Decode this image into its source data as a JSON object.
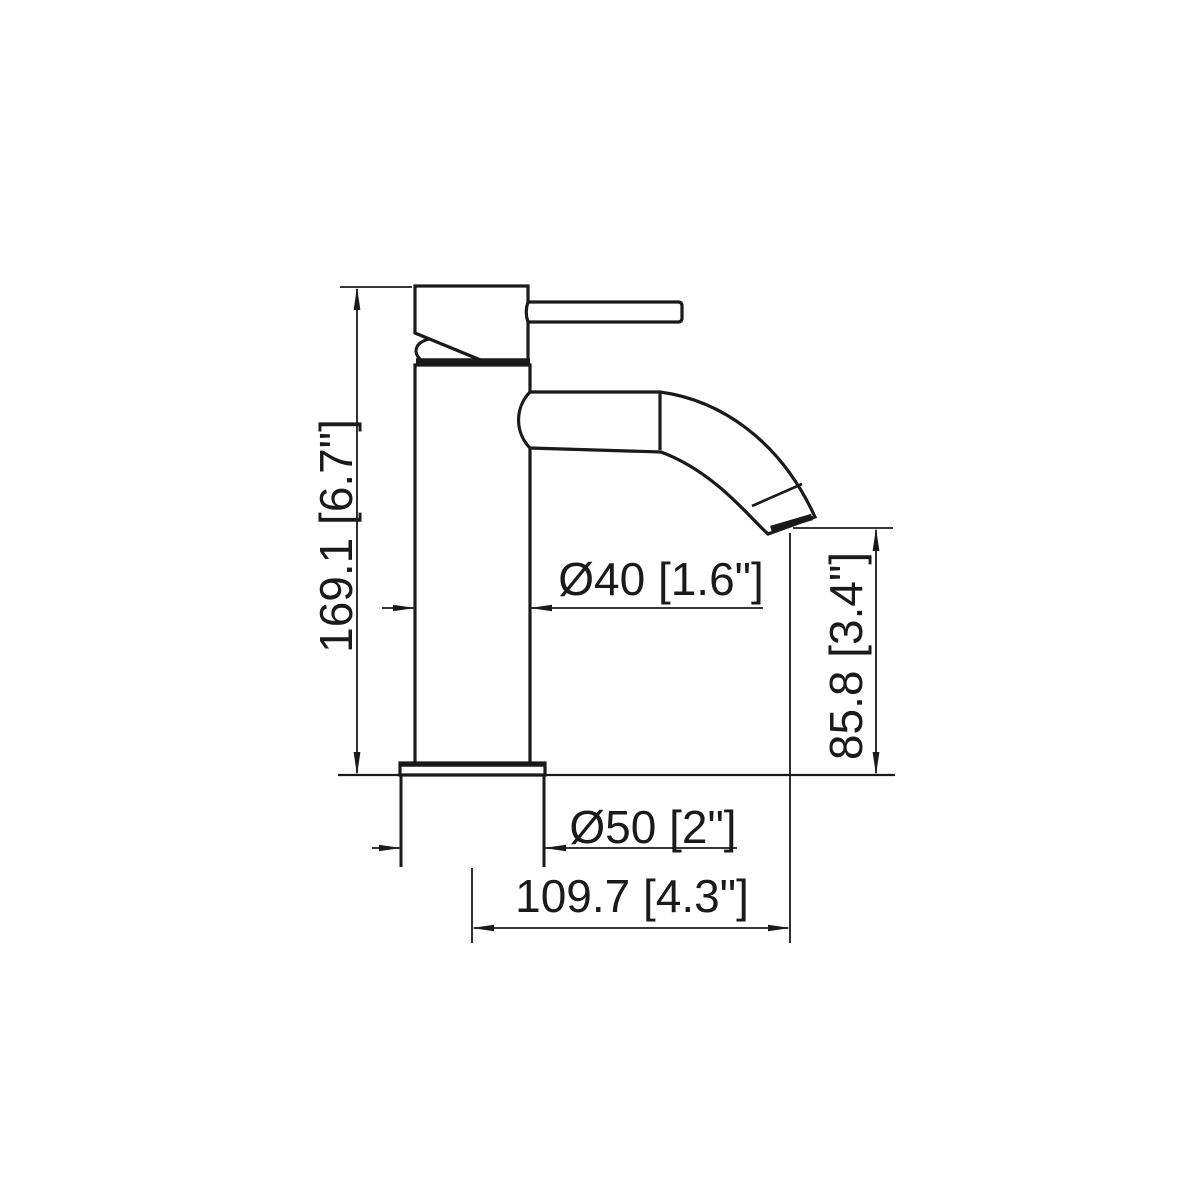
{
  "drawing": {
    "kind": "technical-dimension-drawing",
    "subject": "single-handle basin faucet, side elevation",
    "background_color": "#ffffff",
    "line_color": "#1a1a1a",
    "dimensions": {
      "total_height": {
        "label": "169.1 [6.7\"]",
        "mm": 169.1,
        "inches": 6.7
      },
      "body_diameter": {
        "label": "Ø40 [1.6\"]",
        "mm": 40,
        "inches": 1.6
      },
      "outlet_height": {
        "label": "85.8 [3.4\"]",
        "mm": 85.8,
        "inches": 3.4
      },
      "base_diameter": {
        "label": "Ø50 [2\"]",
        "mm": 50,
        "inches": 2
      },
      "spout_reach": {
        "label": "109.7 [4.3\"]",
        "mm": 109.7,
        "inches": 4.3
      }
    }
  }
}
